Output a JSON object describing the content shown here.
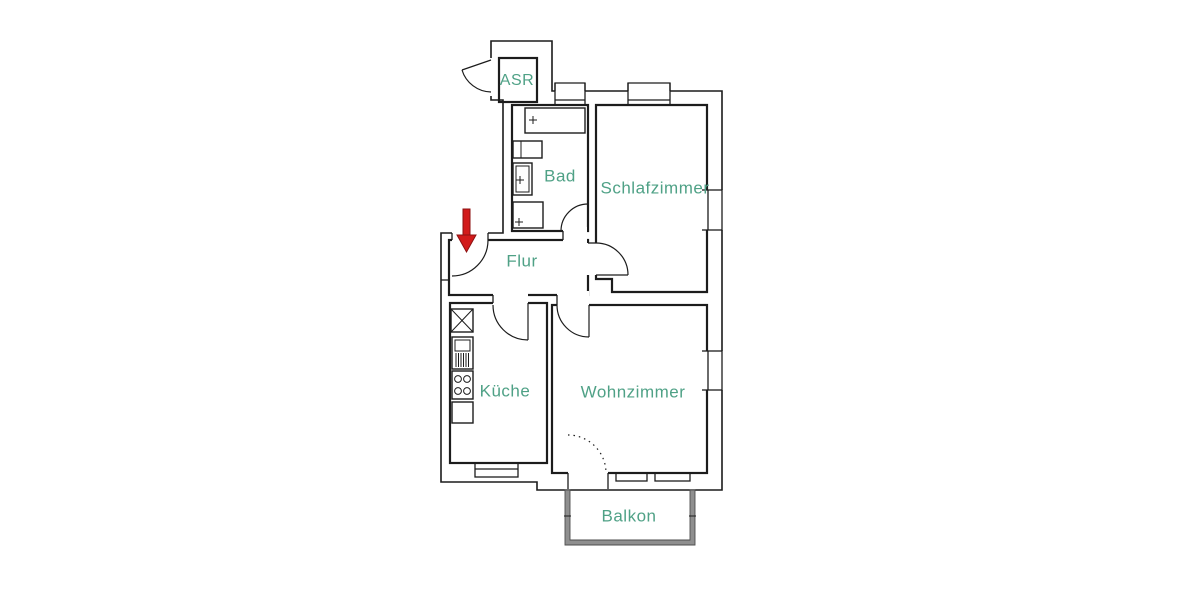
{
  "colors": {
    "label": "#4fa186",
    "wall": "#1c1c1c",
    "arrow": "#d21b1b",
    "balcony_wall": "#8f8f8f"
  },
  "rooms": {
    "asr": {
      "label": "ASR"
    },
    "bad": {
      "label": "Bad"
    },
    "schlafzimmer": {
      "label": "Schlafzimmer"
    },
    "flur": {
      "label": "Flur"
    },
    "kueche": {
      "label": "Küche"
    },
    "wohnzimmer": {
      "label": "Wohnzimmer"
    },
    "balkon": {
      "label": "Balkon"
    }
  }
}
